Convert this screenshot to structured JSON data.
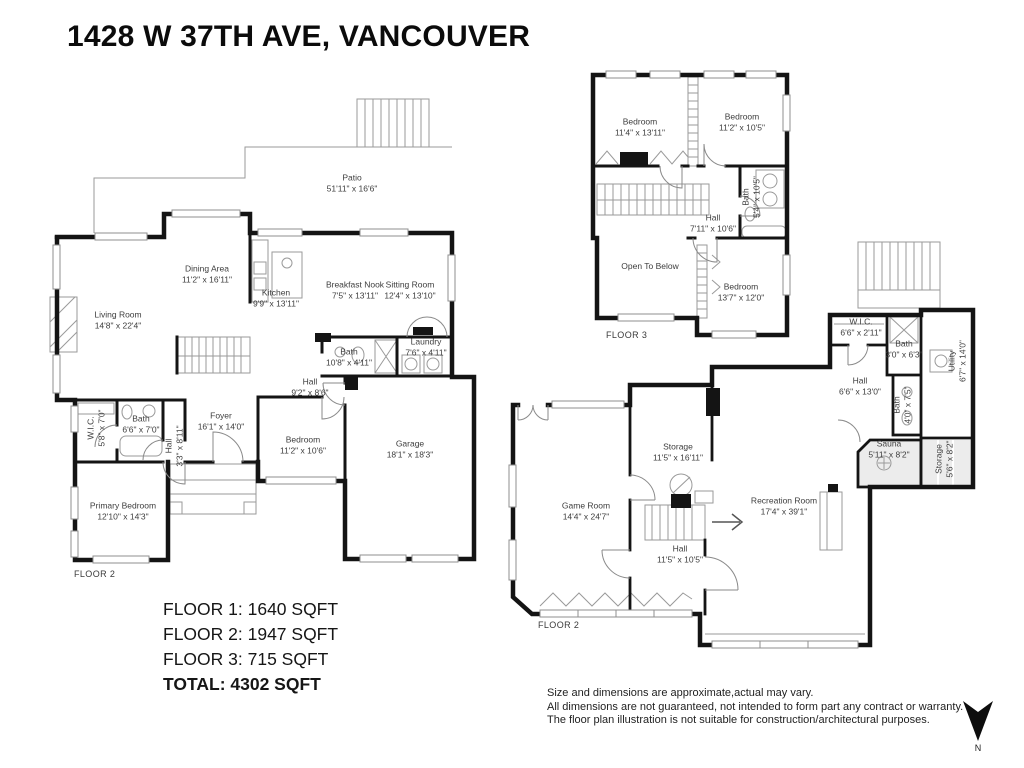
{
  "title": "1428 W 37TH AVE, VANCOUVER",
  "plans": {
    "main": {
      "floor_label": "FLOOR 2",
      "rooms": {
        "patio": {
          "name": "Patio",
          "dims": "51'11\" x 16'6\""
        },
        "dining": {
          "name": "Dining Area",
          "dims": "11'2\" x 16'11\""
        },
        "kitchen": {
          "name": "Kitchen",
          "dims": "9'9\" x 13'11\""
        },
        "nook": {
          "name": "Breakfast Nook",
          "dims": "7'5\" x 13'11\""
        },
        "sitting": {
          "name": "Sitting Room",
          "dims": "12'4\" x 13'10\""
        },
        "living": {
          "name": "Living Room",
          "dims": "14'8\" x 22'4\""
        },
        "bath_center": {
          "name": "Bath",
          "dims": "10'8\" x 4'11\""
        },
        "laundry": {
          "name": "Laundry",
          "dims": "7'6\" x 4'11\""
        },
        "hall": {
          "name": "Hall",
          "dims": "9'2\" x 8'6\""
        },
        "wic": {
          "name": "W.I.C.",
          "dims": "5'8\" x 7'0\""
        },
        "bath_left": {
          "name": "Bath",
          "dims": "6'6\" x 7'0\""
        },
        "hall_small": {
          "name": "Hall",
          "dims": "3'3\" x 8'11\""
        },
        "foyer": {
          "name": "Foyer",
          "dims": "16'1\" x 14'0\""
        },
        "bedroom": {
          "name": "Bedroom",
          "dims": "11'2\" x 10'6\""
        },
        "garage": {
          "name": "Garage",
          "dims": "18'1\" x 18'3\""
        },
        "primary": {
          "name": "Primary Bedroom",
          "dims": "12'10\" x 14'3\""
        }
      }
    },
    "upper": {
      "floor_label": "FLOOR 3",
      "rooms": {
        "bedroom_a": {
          "name": "Bedroom",
          "dims": "11'4\" x 13'11\""
        },
        "bedroom_b": {
          "name": "Bedroom",
          "dims": "11'2\" x 10'5\""
        },
        "bath": {
          "name": "Bath",
          "dims": "5'4\" x 10'5\""
        },
        "hall": {
          "name": "Hall",
          "dims": "7'11\" x 10'6\""
        },
        "open_below": {
          "name": "Open To Below",
          "dims": ""
        },
        "bedroom_c": {
          "name": "Bedroom",
          "dims": "13'7\" x 12'0\""
        }
      }
    },
    "basement": {
      "floor_label": "FLOOR 2",
      "rooms": {
        "storage": {
          "name": "Storage",
          "dims": "11'5\" x 16'11\""
        },
        "game": {
          "name": "Game Room",
          "dims": "14'4\" x 24'7\""
        },
        "rec": {
          "name": "Recreation Room",
          "dims": "17'4\" x 39'1\""
        },
        "hall": {
          "name": "Hall",
          "dims": "11'5\" x 10'5\""
        },
        "wic": {
          "name": "W.I.C.",
          "dims": "6'6\" x 2'11\""
        },
        "bath_top": {
          "name": "Bath",
          "dims": "3'0\" x 6'3\""
        },
        "utility": {
          "name": "Utility",
          "dims": "6'7\" x 14'0\""
        },
        "hall2": {
          "name": "Hall",
          "dims": "6'6\" x 13'0\""
        },
        "bath_small": {
          "name": "Bath",
          "dims": "4'0\" x 7'5\""
        },
        "sauna": {
          "name": "Sauna",
          "dims": "5'11\" x 8'2\""
        },
        "storage_small": {
          "name": "Storage",
          "dims": "5'6\" x 8'2\""
        }
      }
    }
  },
  "summary": {
    "floor1": "FLOOR 1: 1640 SQFT",
    "floor2": "FLOOR 2: 1947 SQFT",
    "floor3": "FLOOR 3: 715 SQFT",
    "total": "TOTAL: 4302 SQFT"
  },
  "disclaimer": {
    "line1": "Size and dimensions are approximate,actual may vary.",
    "line2": "All dimensions are not guaranteed, not intended to form part any contract or warranty.",
    "line3": "The floor plan illustration is not suitable for construction/architectural purposes."
  },
  "compass": {
    "label": "N"
  },
  "colors": {
    "wall": "#141414",
    "thin": "#8f8f8f",
    "text": "#3d3d3d"
  }
}
